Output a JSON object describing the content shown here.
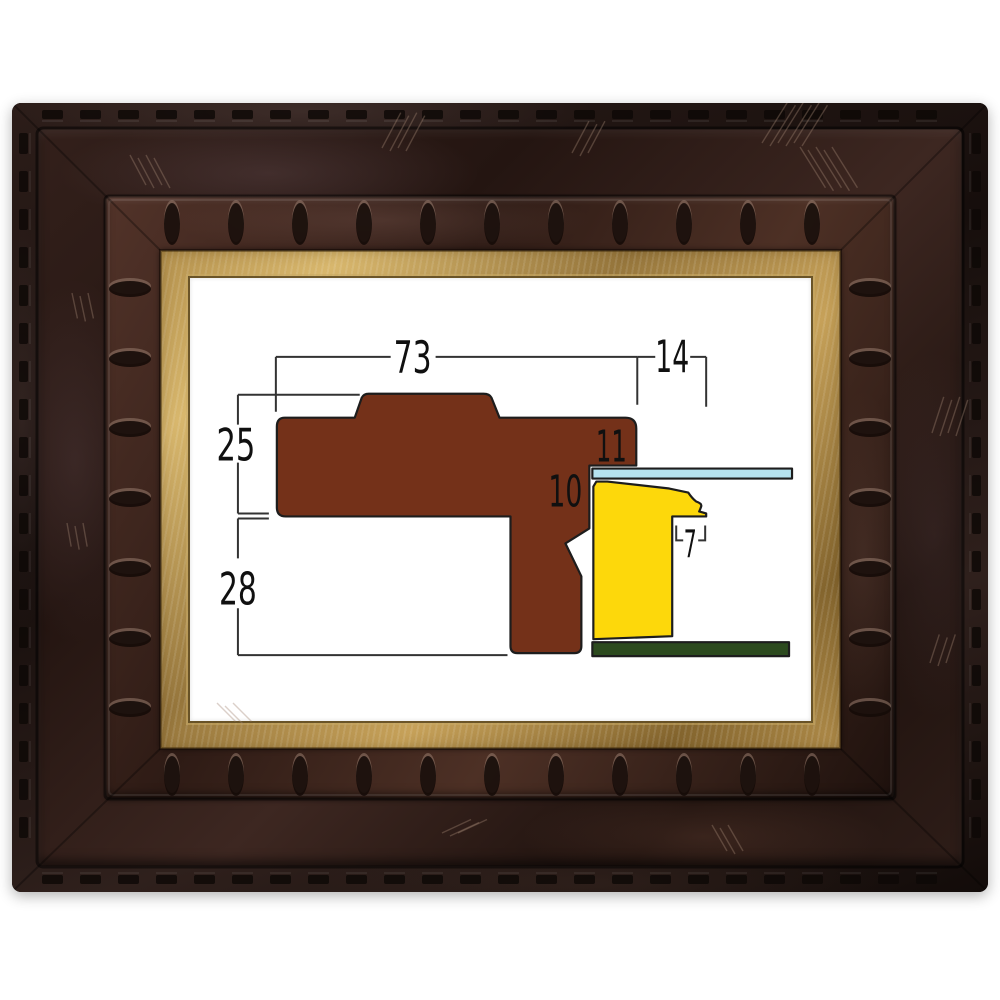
{
  "diagram": {
    "labels": {
      "total_width": "73",
      "overhang_width": "14",
      "upper_height": "25",
      "rabbet_height": "11",
      "glass_step": "10",
      "lower_height": "28",
      "lip_width": "7"
    },
    "colors": {
      "profile": "#743119",
      "canvas": "#fdd80b",
      "glass": "#b5e3ef",
      "backing": "#2c4a1e"
    }
  },
  "frame": {
    "colors": {
      "wood_dark": "#1c1210",
      "wood_mid": "#3a241f",
      "gold": "#c9a55a"
    }
  }
}
